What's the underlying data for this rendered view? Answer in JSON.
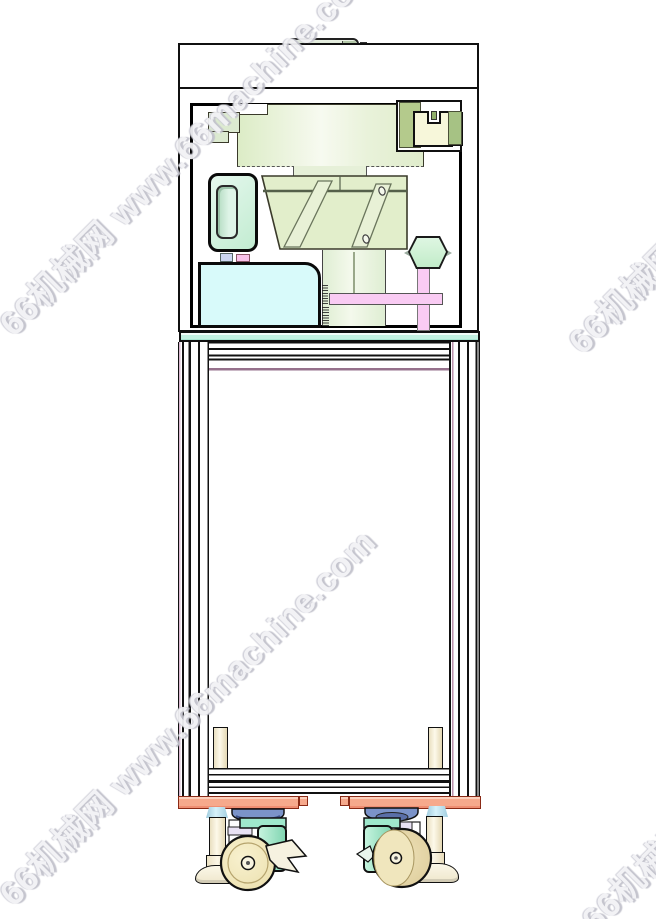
{
  "watermark": {
    "text": "66机械网 www.66machine.com"
  },
  "drawing": {
    "type": "cad-front-view",
    "subject": "feeder machine enclosure mounted on wheeled extrusion cart",
    "colors": {
      "outline": "#101010",
      "machinery_green": "#e6f0d8",
      "tank_mint": "#c8eed4",
      "box_cyan": "#d8fafa",
      "accent_pink": "#f9cbf3",
      "shelf_teal": "#b9eedd",
      "base_salmon": "#f6a98c",
      "wheel_cream": "#f0e7bd",
      "wheel_tan": "#e6d6a6",
      "caster_teal": "#9fe8cc",
      "swivel_blue": "#7b93c9",
      "foot_cream": "#f5efd8",
      "nut_blue": "#c6e9f4",
      "column_accent": "#d9b8d0"
    },
    "components": [
      "top-handle",
      "top-electronics-box",
      "feeder-enclosure",
      "bowl-feeder-cylinder",
      "feeder-body",
      "hopper-tank",
      "control-box-cyan",
      "support-post",
      "cross-bar",
      "adjust-knob",
      "mount-bracket-right",
      "mount-bracket-left",
      "frame-shelf",
      "frame-column-left",
      "frame-column-right",
      "cross-rails-top",
      "cross-rails-bottom",
      "base-plate-left",
      "base-plate-right",
      "leveling-foot-left",
      "leveling-foot-right",
      "caster-left",
      "caster-right"
    ]
  }
}
